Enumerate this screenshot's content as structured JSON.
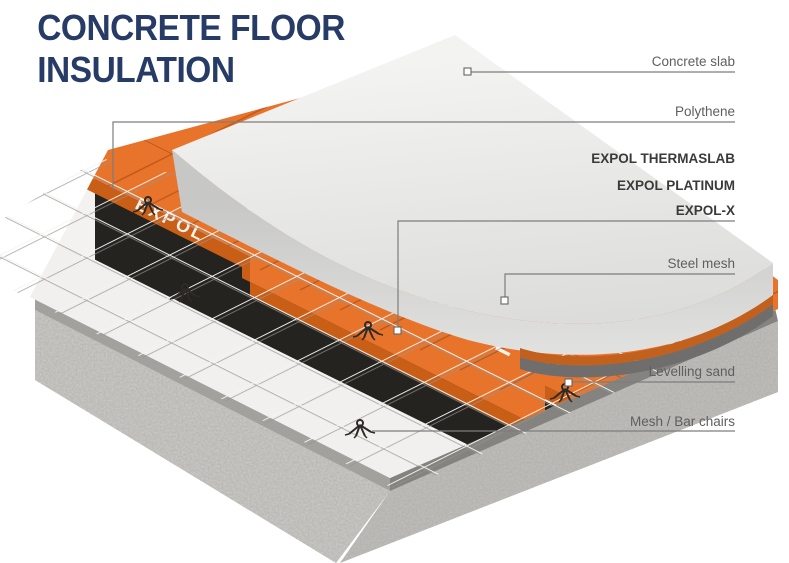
{
  "title": {
    "line1": "CONCRETE FLOOR",
    "line2": "INSULATION"
  },
  "labels": {
    "concrete_slab": "Concrete slab",
    "polythene": "Polythene",
    "expol_thermaslab": "EXPOL THERMASLAB",
    "expol_platinum": "EXPOL PLATINUM",
    "expol_x": "EXPOL-X",
    "steel_mesh": "Steel mesh",
    "levelling_sand": "Levelling sand",
    "mesh_bar_chairs": "Mesh / Bar chairs"
  },
  "illustration": {
    "panel_brand": "EXPOL"
  },
  "colors": {
    "title_navy": "#263b66",
    "panel_orange": "#e8742c",
    "panel_orange_dark": "#c95e17",
    "panel_joint_orange": "#c4591a",
    "polythene_black": "#242320",
    "slab_gray": "#e9e9e8",
    "label_gray": "#5f5f5f",
    "label_dark": "#3a3a3a"
  }
}
